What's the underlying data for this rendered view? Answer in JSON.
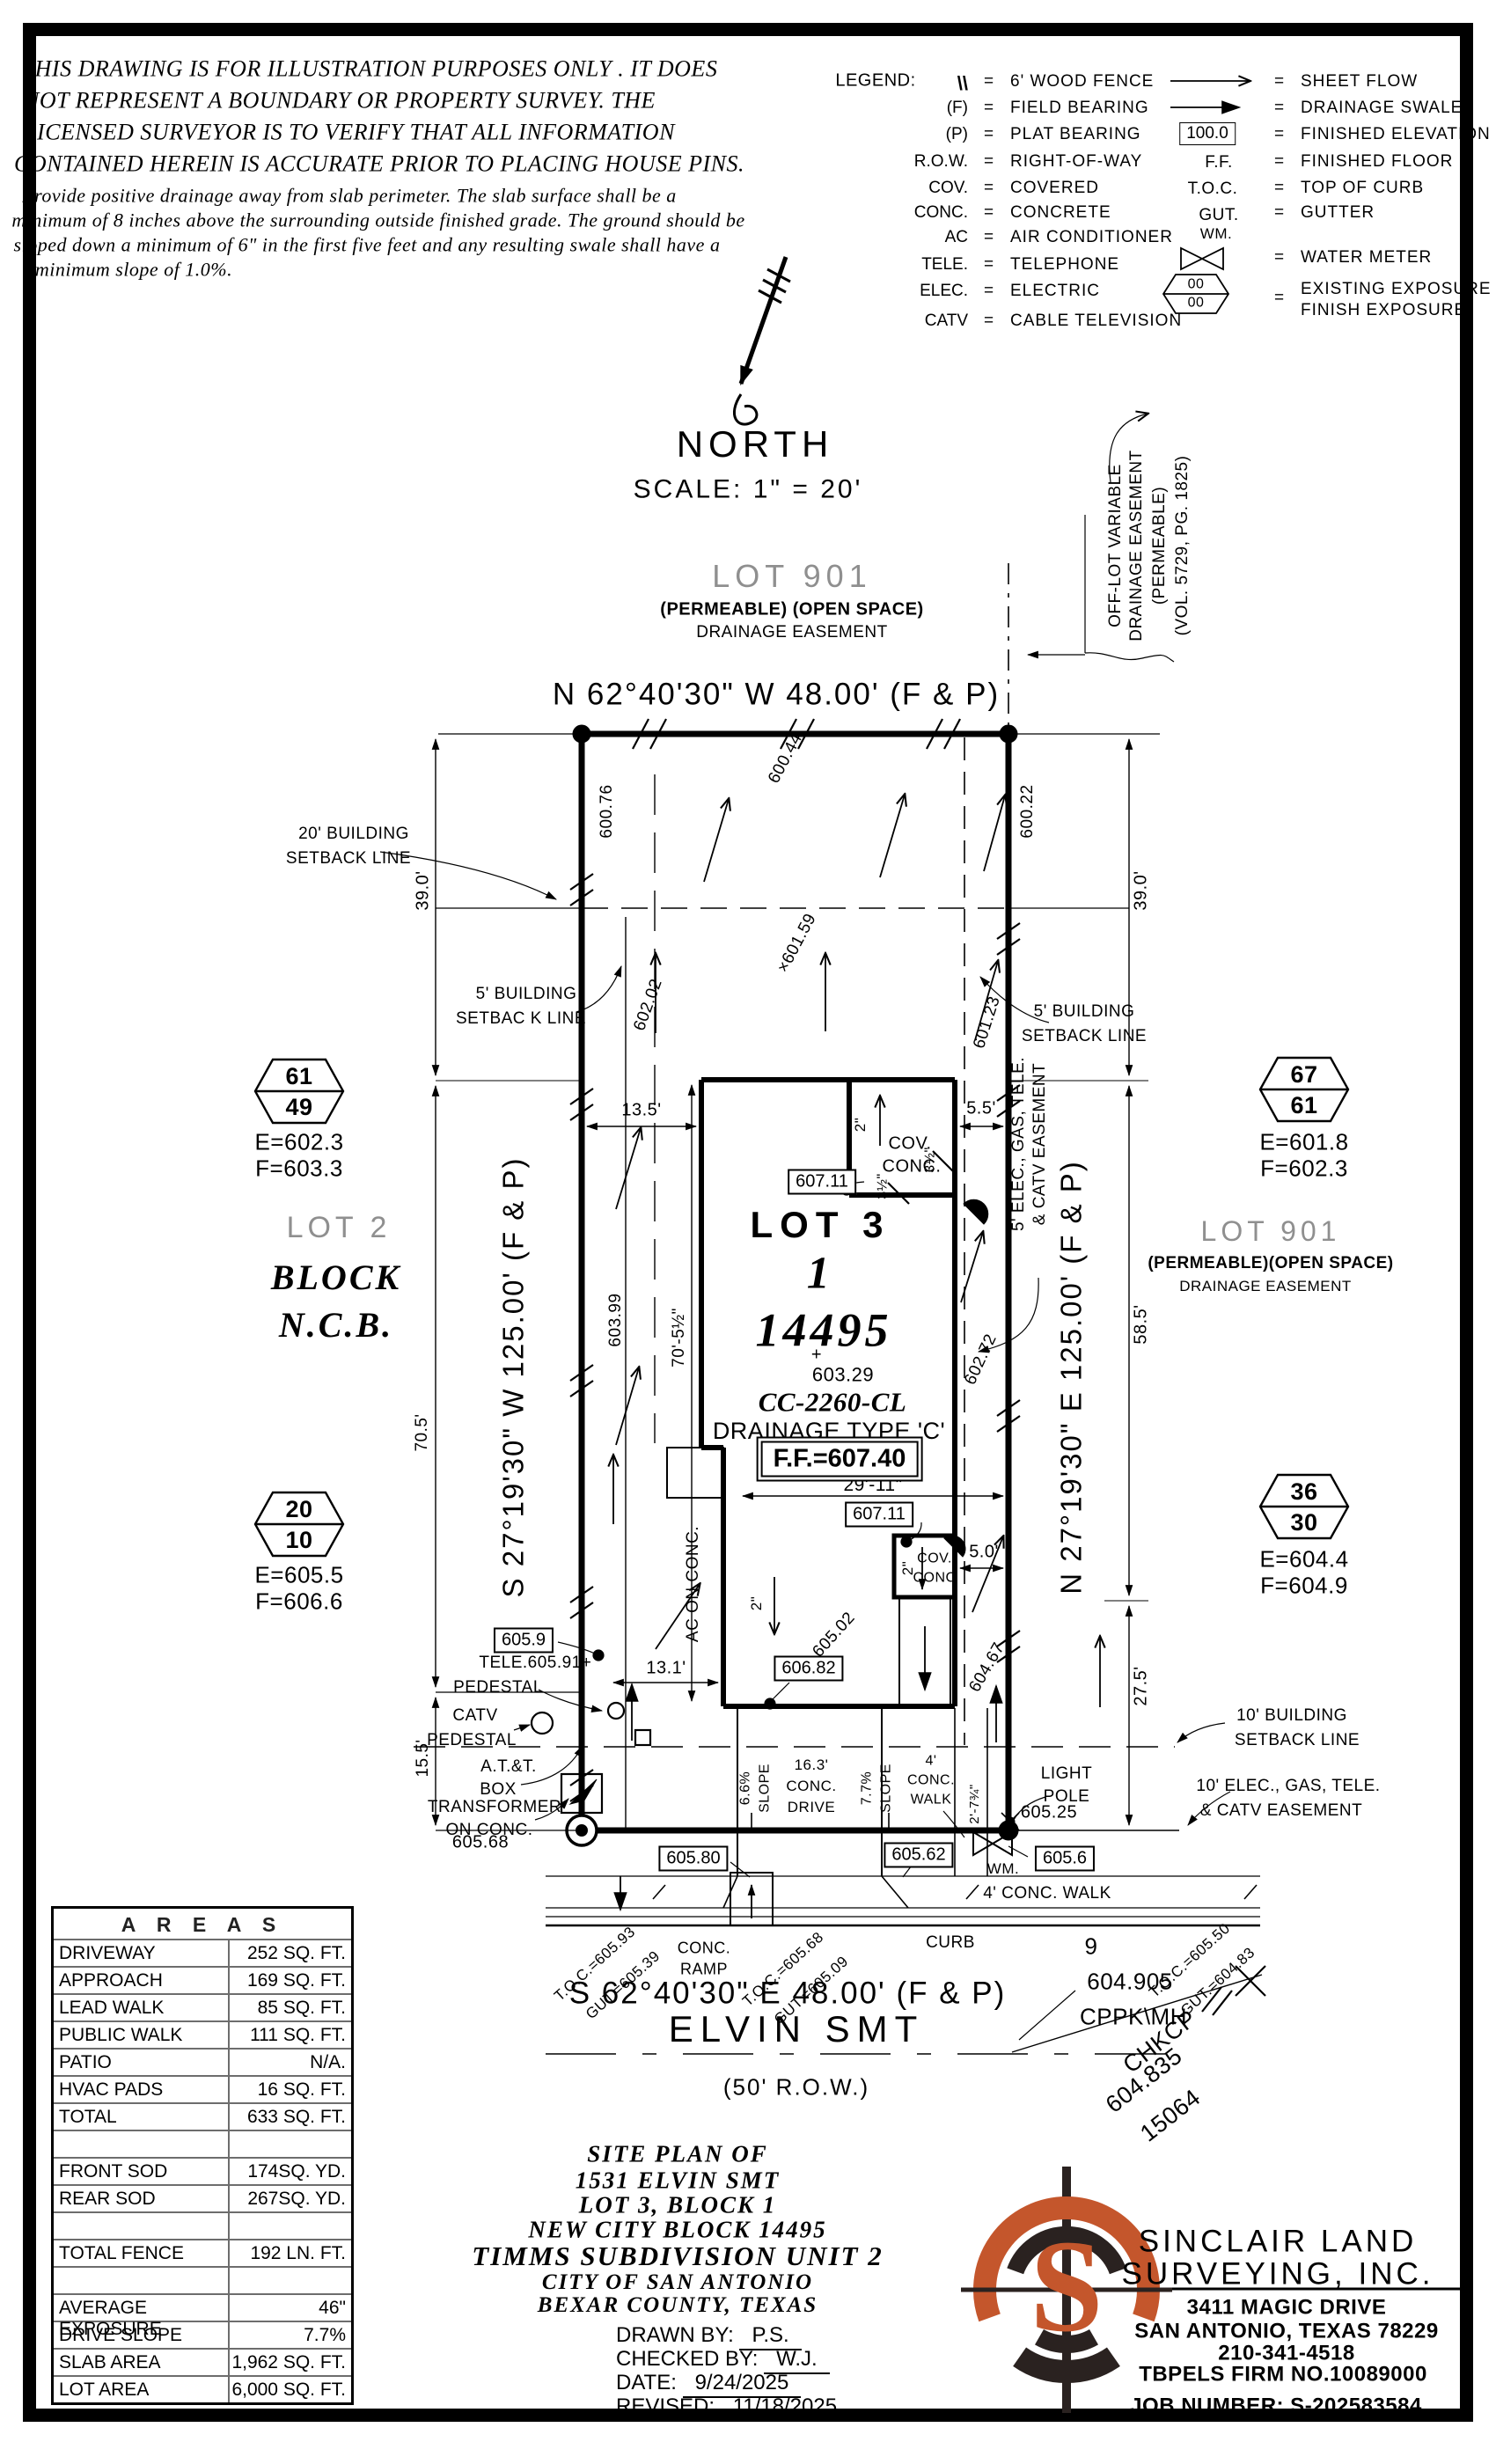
{
  "colors": {
    "ink": "#000000",
    "accent_orange": "#c4562c",
    "logo_dark": "#2a2220",
    "gray_text": "#8f8f8f"
  },
  "disclaimer": {
    "caps": [
      "THIS DRAWING IS FOR ILLUSTRATION PURPOSES ONLY . IT DOES",
      "NOT REPRESENT A BOUNDARY OR PROPERTY SURVEY. THE",
      "LICENSED SURVEYOR IS TO VERIFY THAT ALL INFORMATION",
      "CONTAINED HEREIN IS ACCURATE PRIOR TO PLACING HOUSE PINS."
    ],
    "notes": [
      "Provide positive drainage away from slab perimeter. The slab surface shall be a",
      "minimum of 8 inches above the surrounding outside finished grade. The ground should be",
      "sloped down a minimum of 6\" in the first five feet and any resulting swale shall have a",
      "minimum slope of 1.0%."
    ]
  },
  "legend": {
    "title": "LEGEND:",
    "eq": "=",
    "left": [
      {
        "sym": "\\\\",
        "desc": "6' WOOD FENCE"
      },
      {
        "sym": "(F)",
        "desc": "FIELD BEARING"
      },
      {
        "sym": "(P)",
        "desc": "PLAT BEARING"
      },
      {
        "sym": "R.O.W.",
        "desc": "RIGHT-OF-WAY"
      },
      {
        "sym": "COV.",
        "desc": "COVERED"
      },
      {
        "sym": "CONC.",
        "desc": "CONCRETE"
      },
      {
        "sym": "AC",
        "desc": "AIR CONDITIONER"
      },
      {
        "sym": "TELE.",
        "desc": "TELEPHONE"
      },
      {
        "sym": "ELEC.",
        "desc": "ELECTRIC"
      },
      {
        "sym": "CATV",
        "desc": "CABLE TELEVISION"
      }
    ],
    "right": [
      {
        "sym": "",
        "desc": "SHEET FLOW"
      },
      {
        "sym": "",
        "desc": "DRAINAGE SWALE"
      },
      {
        "sym": "100.0",
        "desc": "FINISHED ELEVATION"
      },
      {
        "sym": "F.F.",
        "desc": "FINISHED FLOOR"
      },
      {
        "sym": "T.O.C.",
        "desc": "TOP OF CURB"
      },
      {
        "sym": "GUT.",
        "desc": "GUTTER"
      },
      {
        "sym": "WM.",
        "desc": "WATER METER"
      },
      {
        "sym": "",
        "desc": "EXISTING EXPOSURE",
        "desc2": "FINISH EXPOSURE",
        "hex_top": "00",
        "hex_bottom": "00"
      }
    ]
  },
  "north": {
    "label": "NORTH",
    "scale": "SCALE: 1\" = 20'"
  },
  "plot": {
    "lot901_top": {
      "title": "LOT 901",
      "sub1": "(PERMEABLE) (OPEN SPACE)",
      "sub2": "DRAINAGE EASEMENT"
    },
    "lot901_right": {
      "title": "LOT 901",
      "sub1": "(PERMEABLE)(OPEN SPACE)",
      "sub2": "DRAINAGE EASEMENT"
    },
    "lot2": {
      "title": "LOT 2",
      "l1": "BLOCK",
      "l2": "N.C.B."
    },
    "bearing_top": "N 62°40'30\" W 48.00' (F & P)",
    "bearing_bottom": "S 62°40'30\" E 48.00' (F & P)",
    "bearing_left": "S 27°19'30\" W 125.00' (F & P)",
    "bearing_right": "N 27°19'30\" E 125.00' (F & P)",
    "offlot": [
      "OFF-LOT VARIABLE",
      "DRAINAGE EASEMENT",
      "(PERMEABLE)",
      "(VOL. 5729, PG. 1825)"
    ],
    "setbacks": {
      "s20": [
        "20' BUILDING",
        "SETBACK LINE"
      ],
      "s5l": [
        "5' BUILDING",
        "SETBAC K LINE"
      ],
      "s5r": [
        "5' BUILDING",
        "SETBACK LINE"
      ],
      "s10": [
        "10' BUILDING",
        "SETBACK LINE"
      ],
      "e10": [
        "10' ELEC., GAS, TELE.",
        "& CATV EASEMENT"
      ],
      "e5": [
        "5' ELEC., GAS, TELE.",
        "& CATV EASEMENT"
      ]
    },
    "house": {
      "lot": "LOT 3",
      "blk": "1",
      "ncb": "14495",
      "plus": "+",
      "spot": "603.29",
      "plan": "CC-2260-CL",
      "drain": "DRAINAGE TYPE 'C'",
      "ff": "F.F.=607.40",
      "cov1a": "COV.",
      "cov1b": "CONC.",
      "cov2a": "COV.",
      "cov2b": "CONC",
      "ac": "AC ON CONC."
    },
    "dims": {
      "d39l": "39.0'",
      "d39r": "39.0'",
      "d705": "70.5'",
      "d155": "15.5'",
      "d585": "58.5'",
      "d275": "27.5'",
      "d135": "13.5'",
      "d55": "5.5'",
      "d50": "5.0'",
      "d131": "13.1'",
      "d2911": "29'-11\"",
      "d70512": "70'-5½\"",
      "d2a": "2\"",
      "d2b": "2\"",
      "d2c": "2\"",
      "d312a": "3½\"",
      "d312b": "3½\"",
      "d278": "2'-7¾\"",
      "slope1a": "6.6%",
      "slope1b": "SLOPE",
      "slope2a": "7.7%",
      "slope2b": "SLOPE",
      "drive1": "16.3'",
      "drive2": "CONC.",
      "drive3": "DRIVE",
      "walk4": "4' CONC. WALK",
      "walk4a": "4'",
      "walk4b": "CONC.",
      "walk4c": "WALK"
    },
    "elev": {
      "e60076": "600.76",
      "e60044": "600.44",
      "e60022": "600.22",
      "e60202": "602.02",
      "e60159": "×601.59",
      "e60123": "601.23",
      "e60399": "603.99",
      "e60272": "602.72",
      "e60467": "604.67",
      "e60502": "605.02",
      "e60591": "605.91+",
      "e60568": "605.68",
      "e60525": "605.25"
    },
    "spots": {
      "b6059": "605.9",
      "b60711a": "607.11",
      "b60711b": "607.11",
      "b60682": "606.82",
      "b60580": "605.80",
      "b60562": "605.62",
      "b6056": "605.6"
    },
    "utilities": {
      "tele1": "TELE.",
      "tele2": "PEDESTAL",
      "catv1": "CATV",
      "catv2": "PEDESTAL",
      "att1": "A.T.&T.",
      "att2": "BOX",
      "xf1": "TRANSFORMER",
      "xf2": "ON CONC.",
      "lp1": "LIGHT",
      "lp2": "POLE",
      "wm": "WM."
    },
    "hex": [
      {
        "top": "61",
        "bottom": "49",
        "e": "E=602.3",
        "f": "F=603.3"
      },
      {
        "top": "20",
        "bottom": "10",
        "e": "E=605.5",
        "f": "F=606.6"
      },
      {
        "top": "67",
        "bottom": "61",
        "e": "E=601.8",
        "f": "F=602.3"
      },
      {
        "top": "36",
        "bottom": "30",
        "e": "E=604.4",
        "f": "F=604.9"
      }
    ],
    "street": {
      "name": "ELVIN SMT",
      "row": "(50' R.O.W.)",
      "curb": "CURB",
      "ramp1": "CONC.",
      "ramp2": "RAMP",
      "chkcp1": "CHKCP",
      "chkcp2": "604.835",
      "chkcp3": "15064",
      "mh1": "9",
      "mh2": "604.905",
      "mh3": "CPPK\\MH",
      "toc1a": "T.O.C.=605.93",
      "toc1b": "GUT.=605.39",
      "toc2a": "T.O.C.=605.68",
      "toc2b": "GUT.=605.09",
      "toc3a": "T.O.C.=605.50",
      "toc3b": "GUT.=604.83"
    }
  },
  "table": {
    "title": "A R E A S",
    "rows": [
      {
        "label": "DRIVEWAY",
        "value": "252 SQ. FT."
      },
      {
        "label": "APPROACH",
        "value": "169 SQ. FT."
      },
      {
        "label": "LEAD WALK",
        "value": "85 SQ. FT."
      },
      {
        "label": "PUBLIC WALK",
        "value": "111 SQ. FT."
      },
      {
        "label": "PATIO",
        "value": "N/A."
      },
      {
        "label": "HVAC PADS",
        "value": "16 SQ. FT."
      },
      {
        "label": "TOTAL",
        "value": "633 SQ. FT."
      },
      {
        "label": "",
        "value": ""
      },
      {
        "label": "FRONT SOD",
        "value": "174SQ. YD."
      },
      {
        "label": "REAR SOD",
        "value": "267SQ. YD."
      },
      {
        "label": "",
        "value": ""
      },
      {
        "label": "TOTAL FENCE",
        "value": "192 LN. FT."
      },
      {
        "label": "",
        "value": ""
      },
      {
        "label": "AVERAGE EXPOSURE",
        "value": "46\""
      },
      {
        "label": "DRIVE SLOPE",
        "value": "7.7%"
      },
      {
        "label": "SLAB AREA",
        "value": "1,962 SQ. FT."
      },
      {
        "label": "LOT AREA",
        "value": "6,000 SQ. FT."
      }
    ]
  },
  "titleblock": {
    "l1": "SITE PLAN OF",
    "l2": "1531 ELVIN SMT",
    "l3": "LOT 3, BLOCK 1",
    "l4": "NEW CITY BLOCK 14495",
    "l5": "TIMMS SUBDIVISION UNIT 2",
    "l6": "CITY OF SAN ANTONIO",
    "l7": "BEXAR COUNTY, TEXAS",
    "f1l": "DRAWN BY:",
    "f1v": "P.S.",
    "f2l": "CHECKED BY:",
    "f2v": "W.J.",
    "f3l": "DATE:",
    "f3v": "9/24/2025",
    "f4l": "REVISED:",
    "f4v": "11/18/2025"
  },
  "company": {
    "logo_letter": "S",
    "name1": "SINCLAIR LAND",
    "name2": "SURVEYING, INC.",
    "addr1": "3411 MAGIC DRIVE",
    "addr2": "SAN ANTONIO, TEXAS 78229",
    "phone": "210-341-4518",
    "firm": "TBPELS FIRM NO.10089000",
    "job": "JOB NUMBER: S-202583584"
  }
}
